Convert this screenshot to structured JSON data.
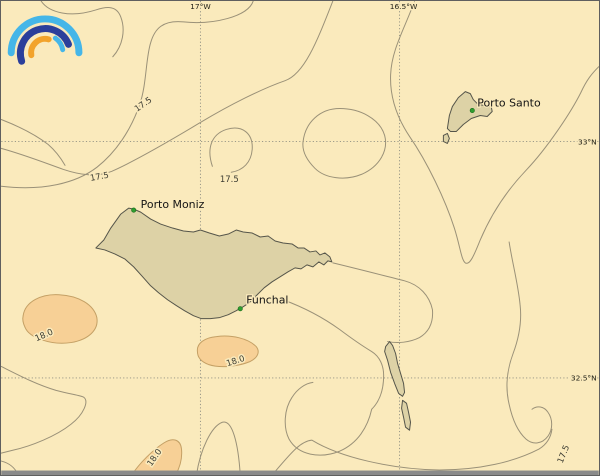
{
  "app": {
    "logo": {
      "name": "rainbow-arcs-logo",
      "outer_arc_color": "#45b6e8",
      "navy_arc_color": "#2b3f9b",
      "orange_arc_color": "#f2a32b",
      "inner_right_arc_color": "#45b6e8"
    }
  },
  "map": {
    "type": "isoline-map",
    "region": "Madeira archipelago",
    "colors": {
      "sea": "#faeabc",
      "land_fill": "#ddd2a6",
      "land_outline": "#55554a",
      "contour_line": "#9a9178",
      "warm_area_fill": "#f7d096",
      "warm_area_outline": "#c4a065",
      "grid_line": "#8f8f82",
      "marker": "#2f9e2f"
    },
    "grid": {
      "meridians": [
        {
          "label": "17°W",
          "x": 200
        },
        {
          "label": "16.5°W",
          "x": 400
        }
      ],
      "parallels": [
        {
          "label": "33°N",
          "y": 141
        },
        {
          "label": "32.5°N",
          "y": 378
        }
      ]
    },
    "islands": [
      "Madeira",
      "Porto Santo",
      "Desertas"
    ],
    "places": [
      {
        "name": "Porto Moniz"
      },
      {
        "name": "Funchal"
      },
      {
        "name": "Porto Santo"
      }
    ],
    "contour_labels": [
      {
        "text": "17.5"
      },
      {
        "text": "17.5"
      },
      {
        "text": "17.5"
      },
      {
        "text": "17.5"
      },
      {
        "text": "18.0"
      },
      {
        "text": "18.0"
      },
      {
        "text": "18.0"
      }
    ]
  }
}
